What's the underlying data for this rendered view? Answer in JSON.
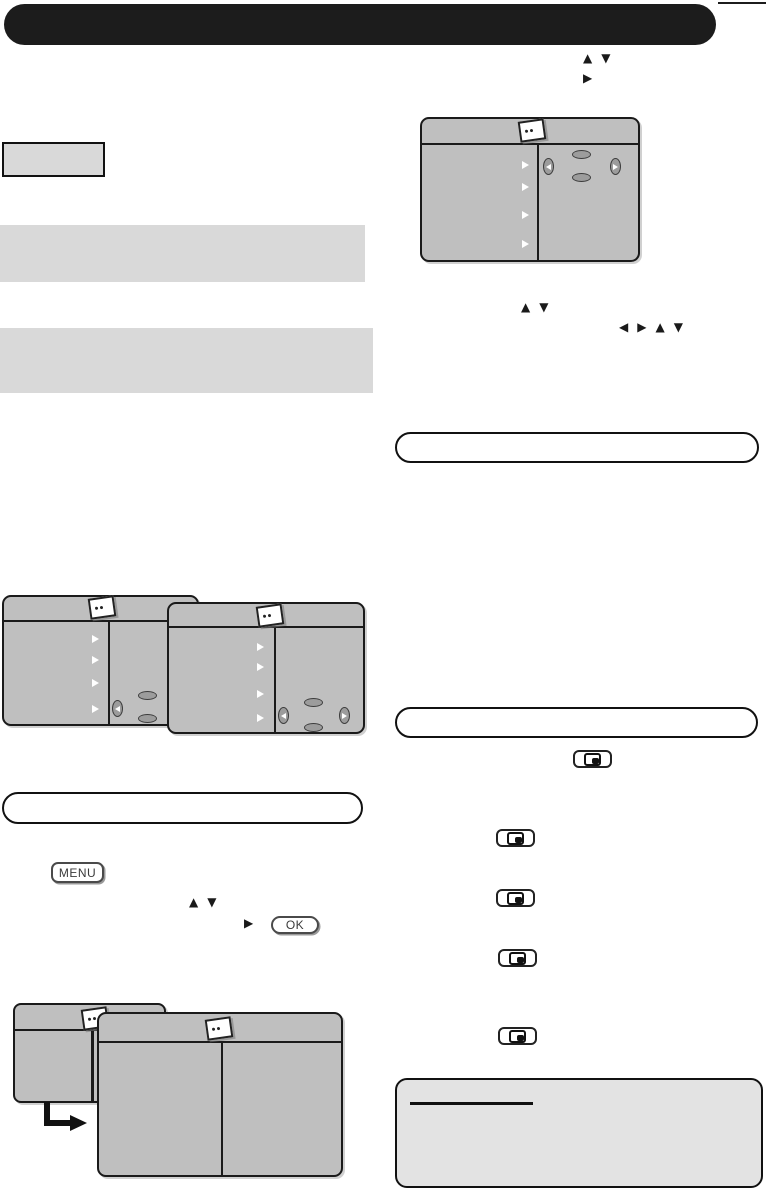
{
  "glyphs": {
    "up": "▲",
    "down": "▼",
    "right": "▶",
    "left": "◀"
  },
  "remote_buttons": {
    "menu": "MENU",
    "ok": "OK"
  },
  "icons": {
    "osd_menu": "osd-menu-icon",
    "display_mode": "display-mode-button-icon",
    "cursor_up": "cursor-up-key-icon",
    "cursor_down": "cursor-down-key-icon",
    "cursor_left": "cursor-left-key-icon",
    "cursor_right": "cursor-right-key-icon",
    "menu_item_marker": "menu-item-arrow-icon",
    "flow_arrow": "flow-arrow-icon"
  },
  "colors": {
    "page_bg": "#ffffff",
    "banner": "#1c1c1c",
    "screen_fill": "#bfbfbf",
    "screen_border": "#1a1a1a",
    "bar_fill": "#d9d9d9",
    "note_fill": "#e3e3e3",
    "key_fill": "#9c9c9c",
    "key_border": "#3d3d3d"
  }
}
